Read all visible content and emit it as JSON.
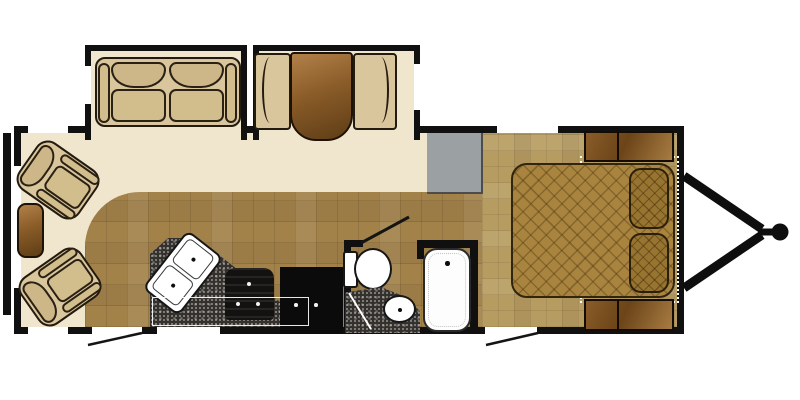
{
  "page": {
    "title": "Travel trailer floor plan",
    "description": "Top-down RV travel trailer floorplan with rear living area, two slide-outs, center kitchen and bath, front bedroom and A-frame hitch"
  },
  "colors": {
    "wall": "#101010",
    "carpet": "#f0e5cd",
    "kitchen_tile": "#a3824a",
    "bedroom_tile": "#b79c61",
    "countertop_speckle": "#34312d",
    "upholstery_tan": "#d9c69c",
    "wood_brown": "#8a5c28",
    "fixture_white": "#ffffff",
    "cabinet_gray": "#9ba0a3",
    "bedspread": "#a9843f"
  },
  "labels": {
    "bumper": "Rear bumper",
    "shell": "Trailer body walls",
    "living_floor": "Living area carpet",
    "kitchen_floor": "Kitchen tile floor",
    "bedroom_floor": "Bedroom tile floor",
    "sofa_slide": "Sofa slide-out",
    "dinette_slide": "Booth dinette slide-out",
    "sofa": "Loveseat sofa",
    "bench": "Dinette bench seat",
    "table": "Dinette table",
    "recliner": "Recliner chair",
    "end_table": "End table",
    "counter": "Kitchen countertop",
    "sink": "Double kitchen sink",
    "stove": "Range cooktop",
    "fridge": "Refrigerator",
    "counter_edge": "Counter edge outline",
    "bath_wall": "Bathroom wall",
    "bath_door": "Bathroom door swing",
    "toilet": "Toilet",
    "vanity": "Vanity counter",
    "vanity_sink": "Vanity sink",
    "tub": "Shower tub",
    "wardrobe": "Wardrobe cabinet",
    "bed_platform": "Bed platform outline",
    "bed": "Bed with quilted spread",
    "pillow": "Pillow",
    "nightstand": "Nightstand cabinet",
    "window": "Window",
    "entry_door": "Entry door opening",
    "door_swing": "Entry door swing",
    "hitch": "A-frame tongue hitch",
    "hitch_ball": "Hitch coupler"
  }
}
